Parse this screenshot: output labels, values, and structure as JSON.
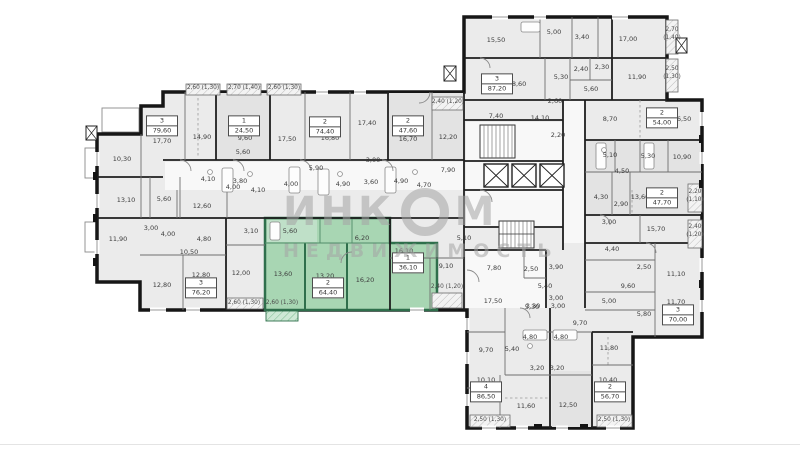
{
  "watermark": {
    "line1_left": "ИНК",
    "line1_right": "М",
    "line2": "НЕДВИЖИМОСТЬ"
  },
  "colors": {
    "wall": "#161616",
    "room_fill": "#ebebeb",
    "corridor_fill": "#f8f8f8",
    "highlight_fill": "#a8d6b3",
    "highlight_wall": "#2f6f4c",
    "hatch_line": "#bdbdbd"
  },
  "apartments": [
    {
      "num": "3",
      "area": "79,60",
      "x": 162,
      "y": 126,
      "highlight": false
    },
    {
      "num": "1",
      "area": "24,50",
      "x": 244,
      "y": 126,
      "highlight": false
    },
    {
      "num": "2",
      "area": "74,40",
      "x": 325,
      "y": 127,
      "highlight": false
    },
    {
      "num": "2",
      "area": "47,60",
      "x": 408,
      "y": 126,
      "highlight": false
    },
    {
      "num": "3",
      "area": "87,20",
      "x": 497,
      "y": 84,
      "highlight": false
    },
    {
      "num": "2",
      "area": "54,00",
      "x": 662,
      "y": 118,
      "highlight": false
    },
    {
      "num": "2",
      "area": "47,70",
      "x": 662,
      "y": 198,
      "highlight": false
    },
    {
      "num": "3",
      "area": "70,00",
      "x": 678,
      "y": 315,
      "highlight": false
    },
    {
      "num": "2",
      "area": "56,70",
      "x": 610,
      "y": 392,
      "highlight": false
    },
    {
      "num": "4",
      "area": "86,50",
      "x": 486,
      "y": 392,
      "highlight": false
    },
    {
      "num": "3",
      "area": "76,20",
      "x": 201,
      "y": 288,
      "highlight": false
    },
    {
      "num": "2",
      "area": "64,40",
      "x": 328,
      "y": 288,
      "highlight": true
    },
    {
      "num": "1",
      "area": "36,10",
      "x": 408,
      "y": 263,
      "highlight": false
    }
  ],
  "room_labels": [
    {
      "t": "17,70",
      "x": 162,
      "y": 141
    },
    {
      "t": "14,90",
      "x": 202,
      "y": 137
    },
    {
      "t": "10,30",
      "x": 122,
      "y": 159
    },
    {
      "t": "9,60",
      "x": 245,
      "y": 138
    },
    {
      "t": "17,50",
      "x": 287,
      "y": 139
    },
    {
      "t": "16,80",
      "x": 330,
      "y": 138
    },
    {
      "t": "17,40",
      "x": 367,
      "y": 123
    },
    {
      "t": "16,70",
      "x": 408,
      "y": 139
    },
    {
      "t": "12,20",
      "x": 448,
      "y": 137
    },
    {
      "t": "5,60",
      "x": 243,
      "y": 152
    },
    {
      "t": "13,10",
      "x": 126,
      "y": 200
    },
    {
      "t": "5,60",
      "x": 164,
      "y": 199
    },
    {
      "t": "4,10",
      "x": 208,
      "y": 179
    },
    {
      "t": "3,80",
      "x": 240,
      "y": 181
    },
    {
      "t": "4,00",
      "x": 233,
      "y": 187
    },
    {
      "t": "4,10",
      "x": 258,
      "y": 190
    },
    {
      "t": "5,90",
      "x": 316,
      "y": 168
    },
    {
      "t": "4,00",
      "x": 291,
      "y": 184
    },
    {
      "t": "3,00",
      "x": 373,
      "y": 160
    },
    {
      "t": "3,60",
      "x": 371,
      "y": 182
    },
    {
      "t": "4,90",
      "x": 343,
      "y": 184
    },
    {
      "t": "4,90",
      "x": 401,
      "y": 181
    },
    {
      "t": "4,70",
      "x": 424,
      "y": 185
    },
    {
      "t": "7,90",
      "x": 448,
      "y": 170
    },
    {
      "t": "12,60",
      "x": 202,
      "y": 206
    },
    {
      "t": "11,90",
      "x": 118,
      "y": 239
    },
    {
      "t": "3,00",
      "x": 151,
      "y": 228
    },
    {
      "t": "4,00",
      "x": 168,
      "y": 234
    },
    {
      "t": "4,80",
      "x": 204,
      "y": 239
    },
    {
      "t": "10,50",
      "x": 189,
      "y": 252
    },
    {
      "t": "12,80",
      "x": 162,
      "y": 285
    },
    {
      "t": "12,80",
      "x": 201,
      "y": 275
    },
    {
      "t": "12,00",
      "x": 241,
      "y": 273
    },
    {
      "t": "3,10",
      "x": 251,
      "y": 231
    },
    {
      "t": "5,60",
      "x": 290,
      "y": 231
    },
    {
      "t": "6,20",
      "x": 362,
      "y": 238
    },
    {
      "t": "13,60",
      "x": 283,
      "y": 274
    },
    {
      "t": "13,20",
      "x": 325,
      "y": 276
    },
    {
      "t": "16,20",
      "x": 365,
      "y": 280
    },
    {
      "t": "16,10",
      "x": 404,
      "y": 251
    },
    {
      "t": "9,10",
      "x": 446,
      "y": 266
    },
    {
      "t": "5,10",
      "x": 464,
      "y": 238
    },
    {
      "t": "15,50",
      "x": 496,
      "y": 40
    },
    {
      "t": "5,00",
      "x": 554,
      "y": 32
    },
    {
      "t": "3,40",
      "x": 582,
      "y": 37
    },
    {
      "t": "17,00",
      "x": 628,
      "y": 39
    },
    {
      "t": "18,60",
      "x": 517,
      "y": 84
    },
    {
      "t": "5,30",
      "x": 561,
      "y": 77
    },
    {
      "t": "2,40",
      "x": 581,
      "y": 69
    },
    {
      "t": "2,30",
      "x": 602,
      "y": 67
    },
    {
      "t": "11,90",
      "x": 637,
      "y": 77
    },
    {
      "t": "5,60",
      "x": 591,
      "y": 89
    },
    {
      "t": "2,60",
      "x": 555,
      "y": 101
    },
    {
      "t": "7,40",
      "x": 496,
      "y": 116
    },
    {
      "t": "14,10",
      "x": 540,
      "y": 118
    },
    {
      "t": "2,20",
      "x": 558,
      "y": 135
    },
    {
      "t": "8,70",
      "x": 610,
      "y": 119
    },
    {
      "t": "16,50",
      "x": 682,
      "y": 119
    },
    {
      "t": "5,10",
      "x": 610,
      "y": 155
    },
    {
      "t": "5,30",
      "x": 648,
      "y": 156
    },
    {
      "t": "10,90",
      "x": 682,
      "y": 157
    },
    {
      "t": "4,50",
      "x": 622,
      "y": 171
    },
    {
      "t": "4,30",
      "x": 601,
      "y": 197
    },
    {
      "t": "2,90",
      "x": 621,
      "y": 204
    },
    {
      "t": "13,60",
      "x": 640,
      "y": 197
    },
    {
      "t": "3,00",
      "x": 609,
      "y": 222
    },
    {
      "t": "15,70",
      "x": 656,
      "y": 229
    },
    {
      "t": "4,40",
      "x": 612,
      "y": 249
    },
    {
      "t": "2,50",
      "x": 644,
      "y": 267
    },
    {
      "t": "11,10",
      "x": 676,
      "y": 274
    },
    {
      "t": "9,60",
      "x": 628,
      "y": 286
    },
    {
      "t": "5,00",
      "x": 609,
      "y": 301
    },
    {
      "t": "5,80",
      "x": 644,
      "y": 314
    },
    {
      "t": "11,70",
      "x": 676,
      "y": 302
    },
    {
      "t": "7,80",
      "x": 494,
      "y": 268
    },
    {
      "t": "2,50",
      "x": 531,
      "y": 269
    },
    {
      "t": "3,90",
      "x": 556,
      "y": 267
    },
    {
      "t": "5,40",
      "x": 545,
      "y": 286
    },
    {
      "t": "17,50",
      "x": 493,
      "y": 301
    },
    {
      "t": "3,30",
      "x": 533,
      "y": 306
    },
    {
      "t": "3,00",
      "x": 556,
      "y": 298
    },
    {
      "t": "9,70",
      "x": 486,
      "y": 350
    },
    {
      "t": "5,40",
      "x": 512,
      "y": 349
    },
    {
      "t": "4,80",
      "x": 530,
      "y": 337
    },
    {
      "t": "4,80",
      "x": 561,
      "y": 337
    },
    {
      "t": "5,30",
      "x": 532,
      "y": 307
    },
    {
      "t": "3,00",
      "x": 558,
      "y": 306
    },
    {
      "t": "9,70",
      "x": 580,
      "y": 323
    },
    {
      "t": "3,20",
      "x": 537,
      "y": 368
    },
    {
      "t": "3,20",
      "x": 557,
      "y": 368
    },
    {
      "t": "10,10",
      "x": 486,
      "y": 380
    },
    {
      "t": "11,60",
      "x": 526,
      "y": 406
    },
    {
      "t": "12,50",
      "x": 568,
      "y": 405
    },
    {
      "t": "11,80",
      "x": 609,
      "y": 348
    },
    {
      "t": "10,40",
      "x": 608,
      "y": 380
    }
  ],
  "balcony_labels": [
    {
      "t": "2,60 (1,30)",
      "x": 203,
      "y": 89
    },
    {
      "t": "2,70 (1,40)",
      "x": 244,
      "y": 89
    },
    {
      "t": "2,60 (1,30)",
      "x": 284,
      "y": 89
    },
    {
      "t": "2,40 (1,20)",
      "x": 448,
      "y": 103
    },
    {
      "t": "2,70",
      "x": 672,
      "y": 31
    },
    {
      "t": "(1,40)",
      "x": 672,
      "y": 39
    },
    {
      "t": "2,50",
      "x": 672,
      "y": 70
    },
    {
      "t": "(1,30)",
      "x": 672,
      "y": 78
    },
    {
      "t": "2,20",
      "x": 695,
      "y": 193
    },
    {
      "t": "(1,10)",
      "x": 695,
      "y": 201
    },
    {
      "t": "2,40",
      "x": 695,
      "y": 228
    },
    {
      "t": "(1,20)",
      "x": 695,
      "y": 236
    },
    {
      "t": "2,60 (1,30)",
      "x": 244,
      "y": 304
    },
    {
      "t": "2,60 (1,30)",
      "x": 282,
      "y": 304
    },
    {
      "t": "2,40 (1,20)",
      "x": 447,
      "y": 288
    },
    {
      "t": "2,50 (1,30)",
      "x": 490,
      "y": 421
    },
    {
      "t": "2,50 (1,30)",
      "x": 614,
      "y": 421
    }
  ]
}
